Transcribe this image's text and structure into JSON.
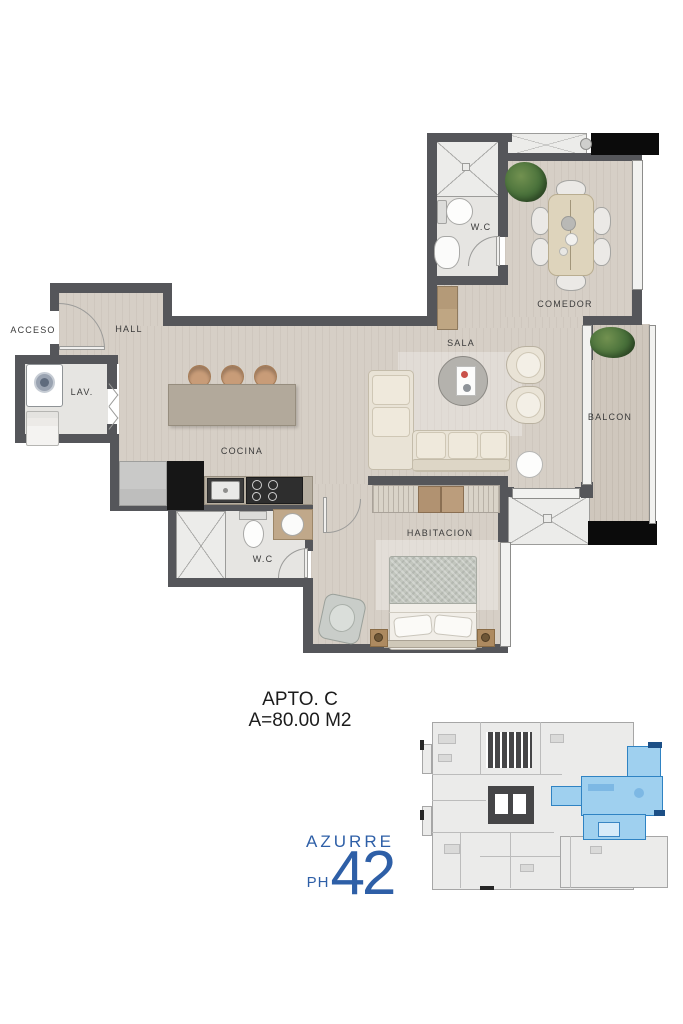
{
  "title": {
    "apto": "APTO. C",
    "area": "A=80.00 M2"
  },
  "rooms": {
    "acceso": "ACCESO",
    "hall": "HALL",
    "lav": "LAV.",
    "cocina": "COCINA",
    "sala": "SALA",
    "comedor": "COMEDOR",
    "balcon": "BALCON",
    "habitacion": "HABITACION",
    "wc1": "W.C",
    "wc2": "W.C"
  },
  "logo": {
    "brand": "AZURRE",
    "number": "42",
    "suffix": "PH",
    "color": "#2e5fa7"
  },
  "keyplan": {
    "highlight_fill": "#9fd0ef",
    "highlight_wall": "#2f83c3"
  },
  "colors": {
    "wall": "#55565a",
    "wood_floor": "#d6cfc6",
    "balcony_floor": "#cfc7bd",
    "tile": "#e6e5e2",
    "slab_black": "#0b0b0b",
    "plant_green": "#48703a",
    "logo_blue": "#2e5fa7"
  }
}
